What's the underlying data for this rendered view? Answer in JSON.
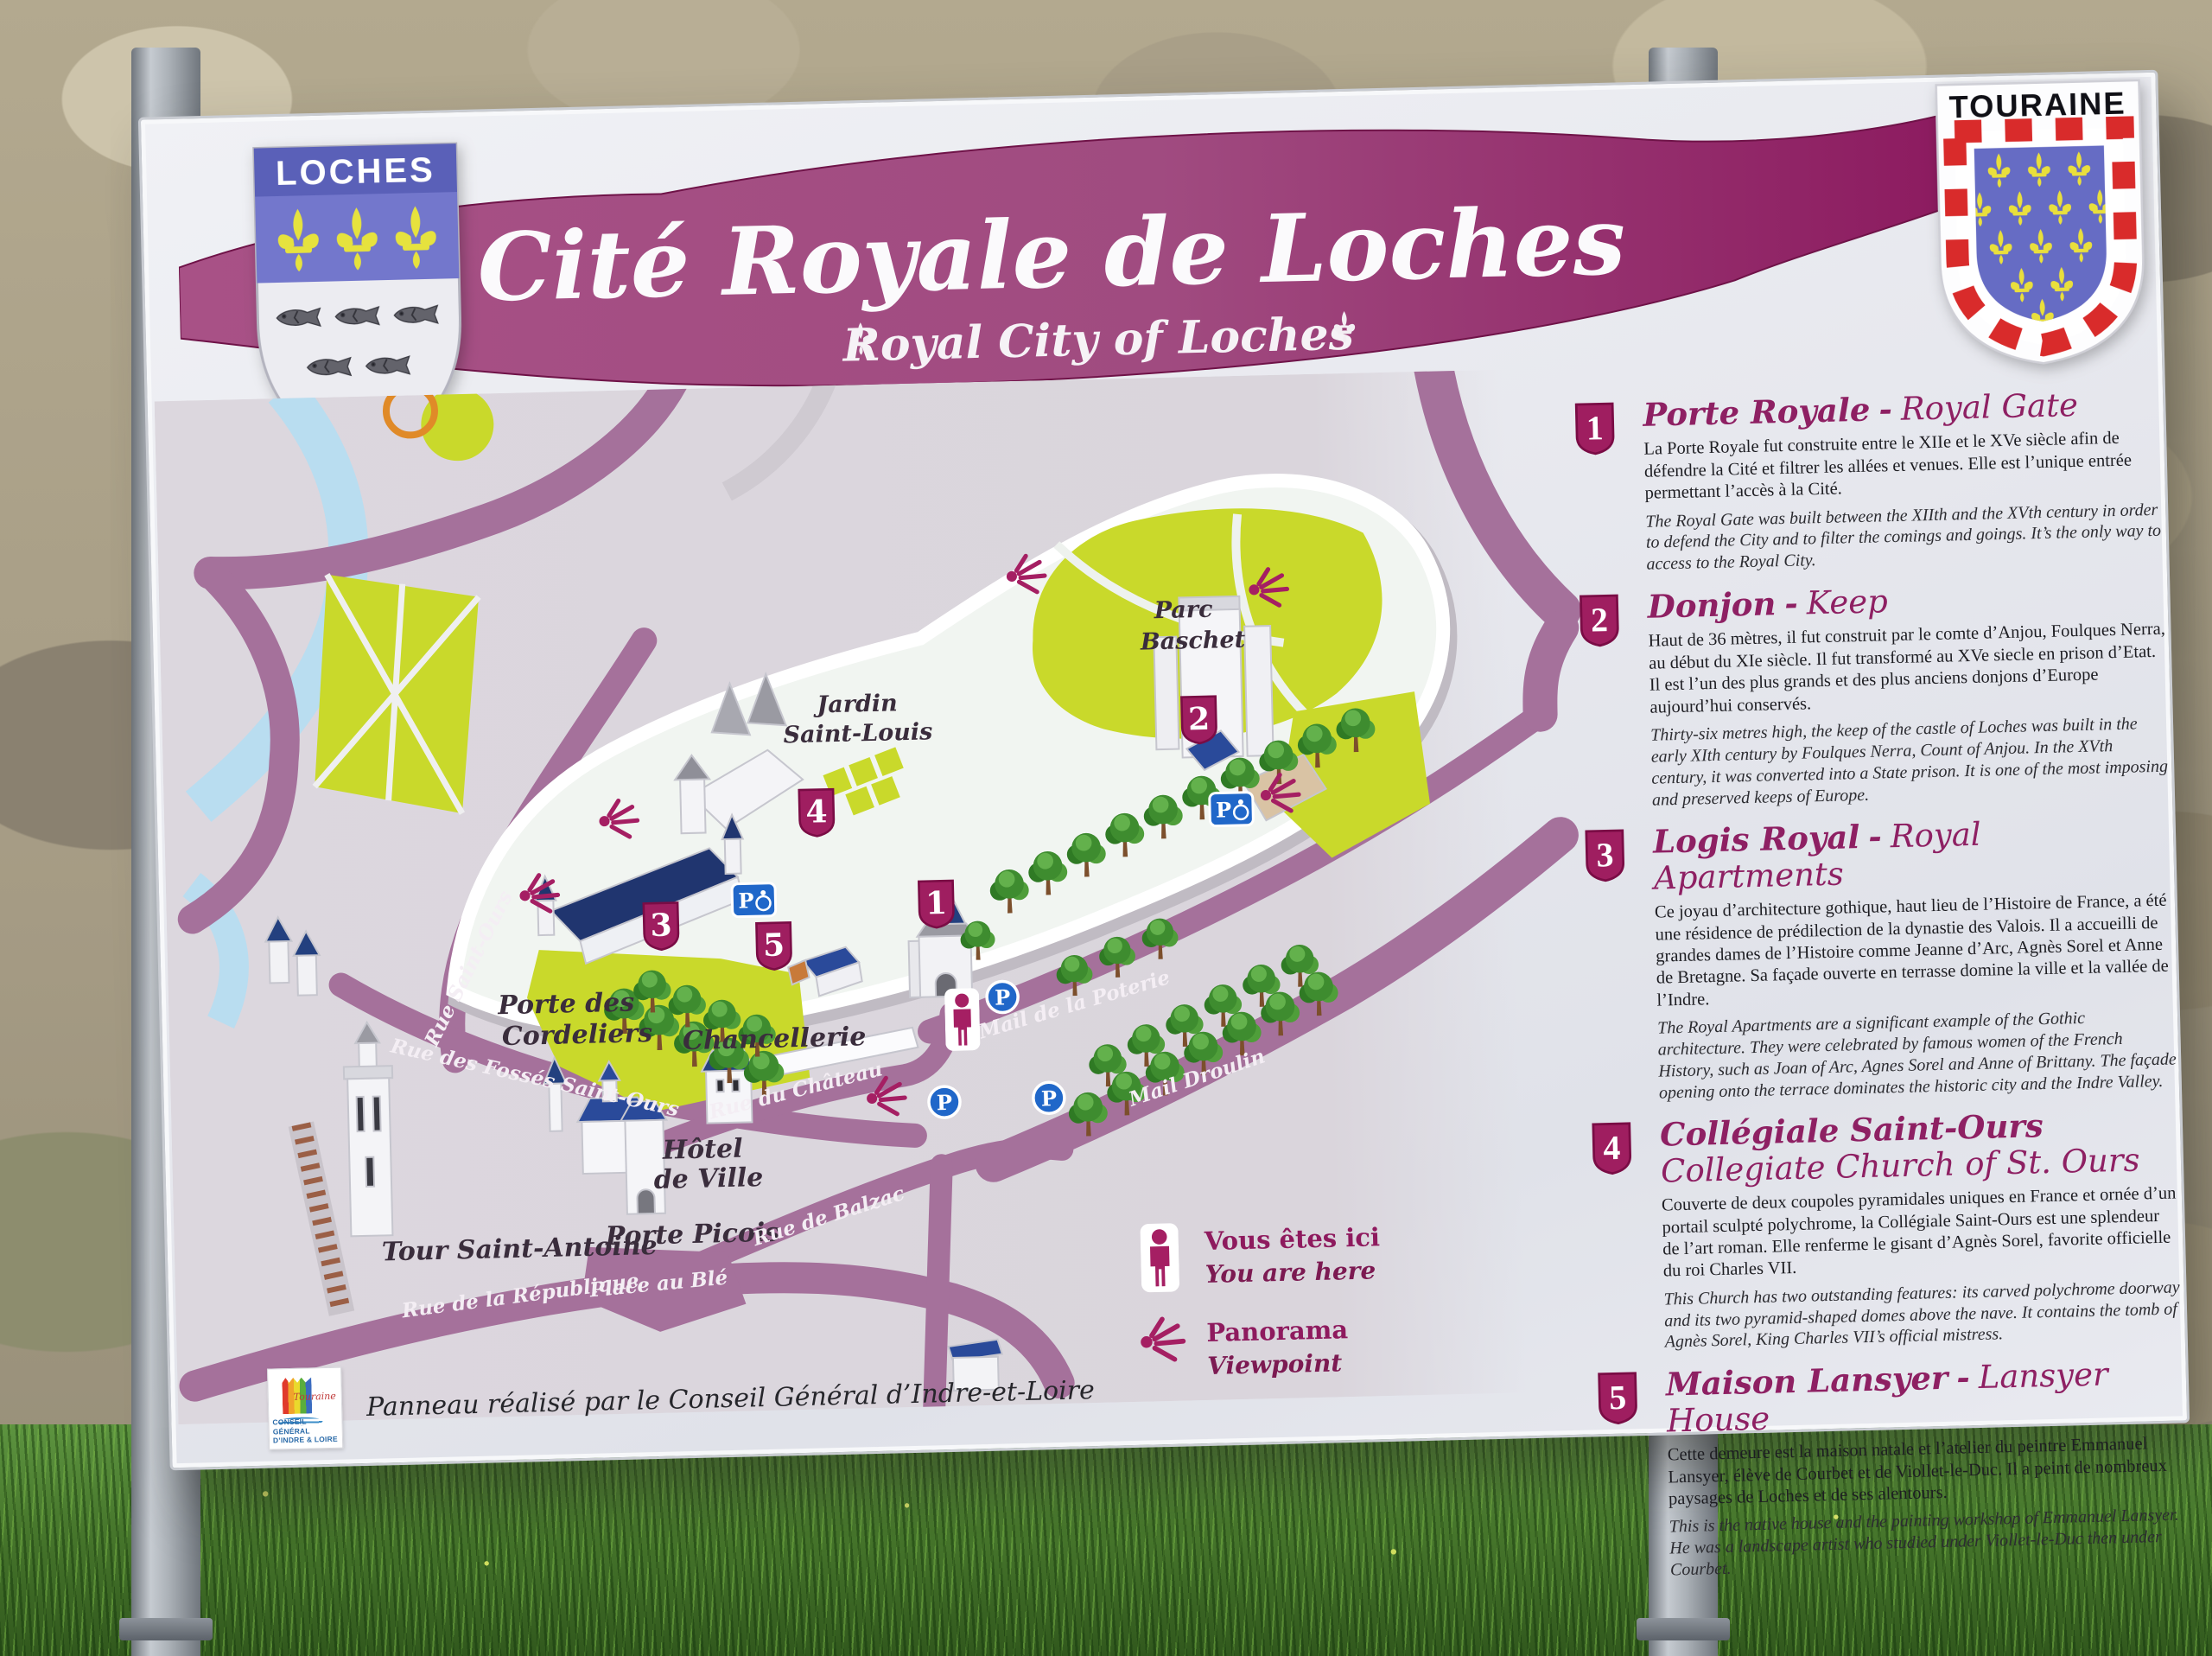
{
  "header": {
    "title": "Cité Royale de Loches",
    "subtitle": "Royal City of Loches"
  },
  "shields": {
    "loches": {
      "label": "LOCHES"
    },
    "touraine": {
      "label": "TOURAINE"
    }
  },
  "sections": [
    {
      "num": "1",
      "title_fr": "Porte Royale",
      "sep": "-",
      "title_en": "Royal Gate",
      "body_fr": "La Porte Royale fut construite entre le XIIe et le XVe siècle afin de défendre la Cité et filtrer les allées et venues. Elle est l’unique entrée permettant l’accès à la Cité.",
      "body_en": "The Royal Gate was built between the XIIth and the XVth century in order to defend the City and to filter the comings and goings. It’s the only way to access to the Royal City."
    },
    {
      "num": "2",
      "title_fr": "Donjon",
      "sep": "-",
      "title_en": "Keep",
      "body_fr": "Haut de 36 mètres, il fut construit par le comte d’Anjou, Foulques Nerra, au début du XIe siècle. Il fut transformé au XVe siecle en prison d’Etat. Il est l’un des plus grands et des plus anciens donjons d’Europe aujourd’hui conservés.",
      "body_en": "Thirty-six metres high, the keep of the castle of Loches was built in the early XIth century by Foulques Nerra, Count of Anjou. In the XVth century, it was converted into a State prison. It is one of the most imposing and preserved keeps of Europe."
    },
    {
      "num": "3",
      "title_fr": "Logis Royal",
      "sep": "-",
      "title_en": "Royal Apartments",
      "body_fr": "Ce joyau d’architecture gothique, haut lieu de l’Histoire de France, a été une résidence de prédilection de la dynastie des Valois. Il a accueilli de grandes dames de l’Histoire comme Jeanne d’Arc, Agnès Sorel et Anne de Bretagne. Sa façade ouverte en terrasse domine la ville et la vallée de l’Indre.",
      "body_en": "The Royal Apartments are a significant example of the Gothic architecture. They were celebrated by famous women of the French History, such as Joan of Arc, Agnes Sorel and Anne of Brittany. The façade opening onto the terrace dominates the historic city and the Indre Valley."
    },
    {
      "num": "4",
      "title_fr": "Collégiale Saint-Ours",
      "sep": "",
      "title_en": "Collegiate Church of St. Ours",
      "body_fr": "Couverte de deux coupoles pyramidales uniques en France et ornée d’un portail sculpté polychrome, la Collégiale Saint-Ours est une splendeur de l’art roman. Elle renferme le gisant d’Agnès Sorel, favorite officielle du roi Charles VII.",
      "body_en": "This Church has two outstanding features: its carved polychrome doorway and its two pyramid-shaped domes above the nave. It contains the tomb of Agnès Sorel, King Charles VII’s official mistress."
    },
    {
      "num": "5",
      "title_fr": "Maison Lansyer",
      "sep": "-",
      "title_en": "Lansyer House",
      "body_fr": "Cette demeure est la maison natale et l’atelier du peintre Emmanuel Lansyer, élève de Courbet et de Viollet-le-Duc. Il a peint de nombreux paysages de Loches et de ses alentours.",
      "body_en": "This is the native house and the painting workshop of Emmanuel Lansyer. He was a landscape artist who studied under Viollet-le-Duc then under Courbet."
    }
  ],
  "map": {
    "parking": "P",
    "labels": {
      "jardin_1": "Jardin",
      "jardin_2": "Saint-Louis",
      "parc_1": "Parc",
      "parc_2": "Baschet",
      "cordeliers_1": "Porte des",
      "cordeliers_2": "Cordeliers",
      "tour_antoine": "Tour Saint-Antoine",
      "hotel_1": "Hôtel",
      "hotel_2": "de Ville",
      "chancellerie": "Chancellerie",
      "porte_picois": "Porte Picois",
      "rue_saint_ours": "Rue Saint-Ours",
      "rue_fosses": "Rue des Fossés Saint-Ours",
      "rue_republique": "Rue de la République",
      "place_ble": "Place au Blé",
      "rue_chateau": "Rue du Château",
      "rue_balzac": "Rue de Balzac",
      "mail_poterie": "Mail de la Poterie",
      "mail_droulin": "Mail Droulin"
    }
  },
  "legend": {
    "here_fr": "Vous êtes ici",
    "here_en": "You are here",
    "pano_fr": "Panorama",
    "pano_en": "Viewpoint"
  },
  "footer": {
    "credit": "Panneau réalisé par le Conseil Général d’Indre-et-Loire",
    "logo_touraine": "Touraine",
    "logo_line1": "CONSEIL GÉNÉRAL",
    "logo_line2": "D’INDRE & LOIRE"
  }
}
